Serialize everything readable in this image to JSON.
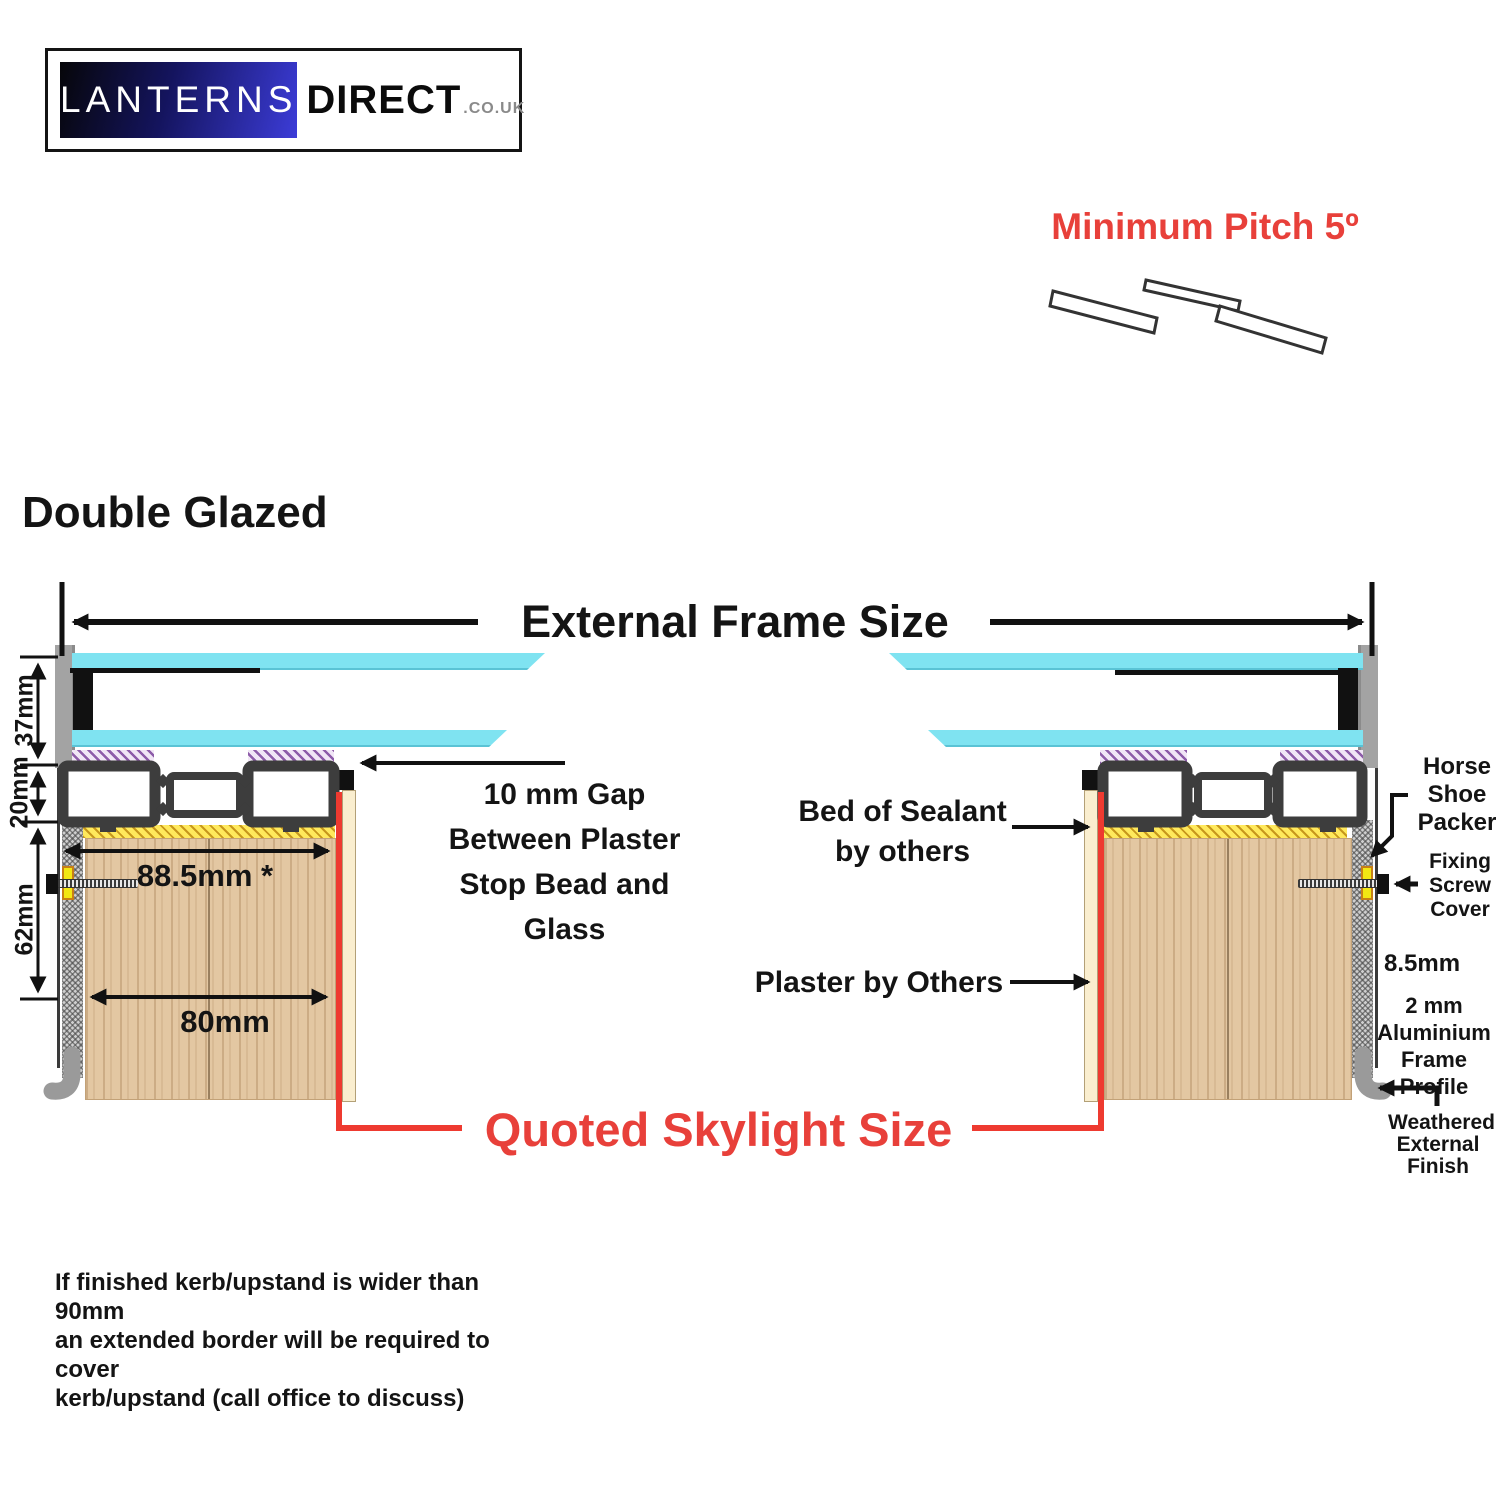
{
  "logo": {
    "brand": "LANTERNS",
    "brand2": "DIRECT",
    "tld": ".CO.UK"
  },
  "pitch": {
    "label": "Minimum Pitch 5º"
  },
  "heading": "Double Glazed",
  "frame": {
    "external_label": "External Frame Size",
    "quoted_label": "Quoted Skylight Size"
  },
  "dimensions": {
    "glass": "37mm",
    "profile": "20mm",
    "upstand": "62mm",
    "overall": "88.5mm *",
    "kerb": "80mm",
    "gap": "8.5mm"
  },
  "annotations": {
    "gap": {
      "lines": [
        "10 mm Gap",
        "Between Plaster",
        "Stop Bead and",
        "Glass"
      ]
    },
    "sealant": {
      "lines": [
        "Bed of Sealant",
        "by others"
      ]
    },
    "plaster": {
      "label": "Plaster by Others"
    },
    "packer": {
      "lines": [
        "Horse",
        "Shoe",
        "Packer"
      ]
    },
    "screw_cover": {
      "lines": [
        "Fixing",
        "Screw",
        "Cover"
      ]
    },
    "alu": {
      "lines": [
        "2 mm",
        "Aluminium",
        "Frame Profile"
      ]
    },
    "weathered": {
      "lines": [
        "Weathered",
        "External",
        "Finish"
      ]
    }
  },
  "note": {
    "lines": [
      "If finished kerb/upstand is wider than 90mm",
      "an extended border will be required to cover",
      "kerb/upstand (call office to discuss)"
    ]
  },
  "colors": {
    "accent_red": "#e8403a",
    "line_red": "#ee3a30",
    "glass_cyan": "#7fe3f1",
    "wood_tan": "#e3c7a2",
    "frame_gray": "#a3a3a3",
    "profile_dark": "#3d3d3d",
    "packer_yellow": "#f2e713",
    "hatch_purple": "#8d5ca9",
    "hatch_yellow": "#ffe95c"
  }
}
